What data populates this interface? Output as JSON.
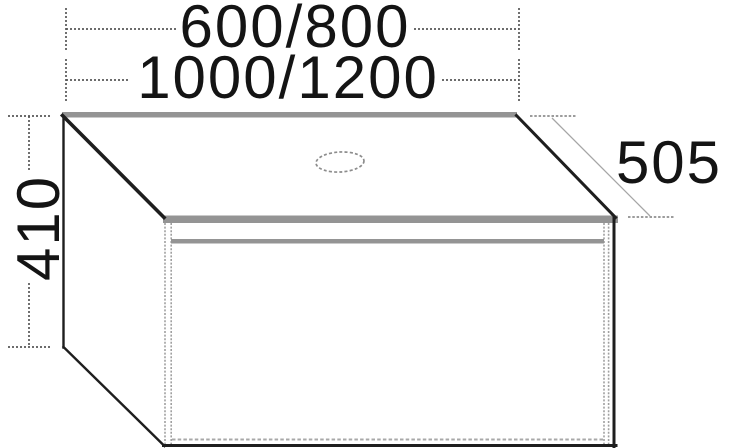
{
  "drawing": {
    "type": "furniture-dimension-diagram",
    "subject": "washbasin vanity unit with countertop, drawer and tap hole",
    "dimensions": {
      "top_width": "600/800",
      "bottom_width": "1000/1200",
      "depth": "505",
      "height": "410"
    },
    "colors": {
      "background": "#ffffff",
      "outline": "#1e1e1e",
      "panel_gray": "#949494",
      "dimension_line": "#575757",
      "label_text": "#141414"
    }
  }
}
